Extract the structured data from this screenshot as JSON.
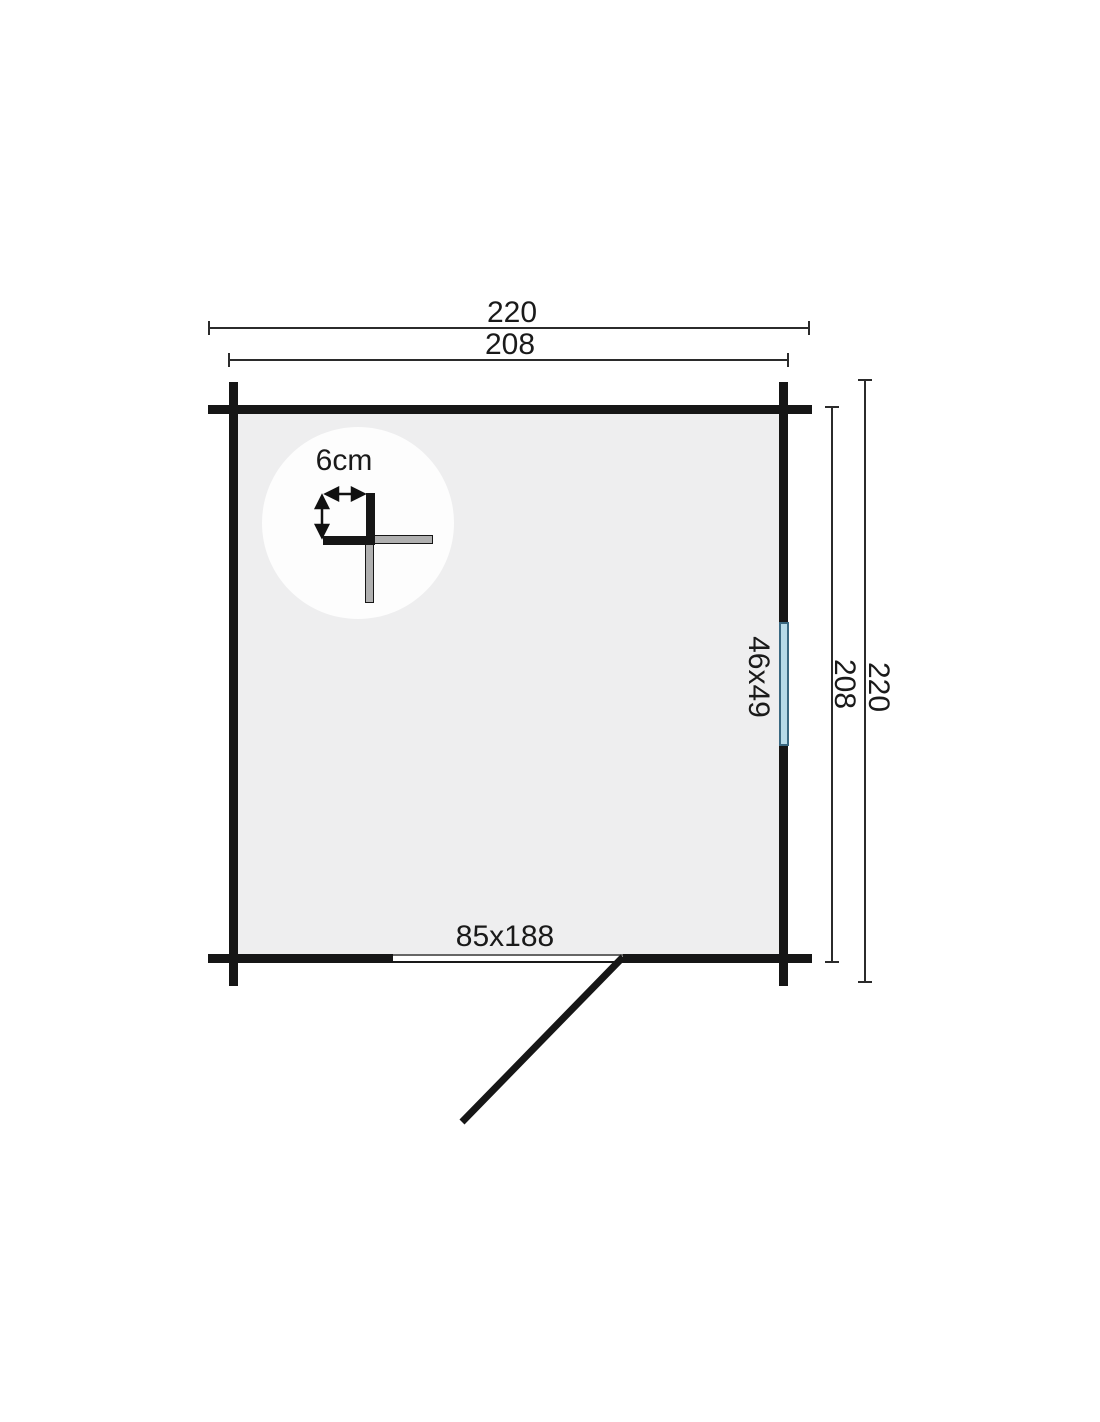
{
  "plan": {
    "labels": {
      "outer_width": "220",
      "inner_width": "208",
      "outer_depth": "220",
      "inner_depth": "208",
      "door_size": "85x188",
      "window_size": "46x49",
      "wall_thickness": "6cm"
    },
    "colors": {
      "wall": "#161616",
      "interior": "#eeeeef",
      "window_fill": "#b7dbe9",
      "window_frame": "#3a6881",
      "log_end_gray": "#b0b0b0",
      "dimension_line": "#2b2b2b",
      "text": "#1a1a1a",
      "background": "#ffffff"
    }
  }
}
